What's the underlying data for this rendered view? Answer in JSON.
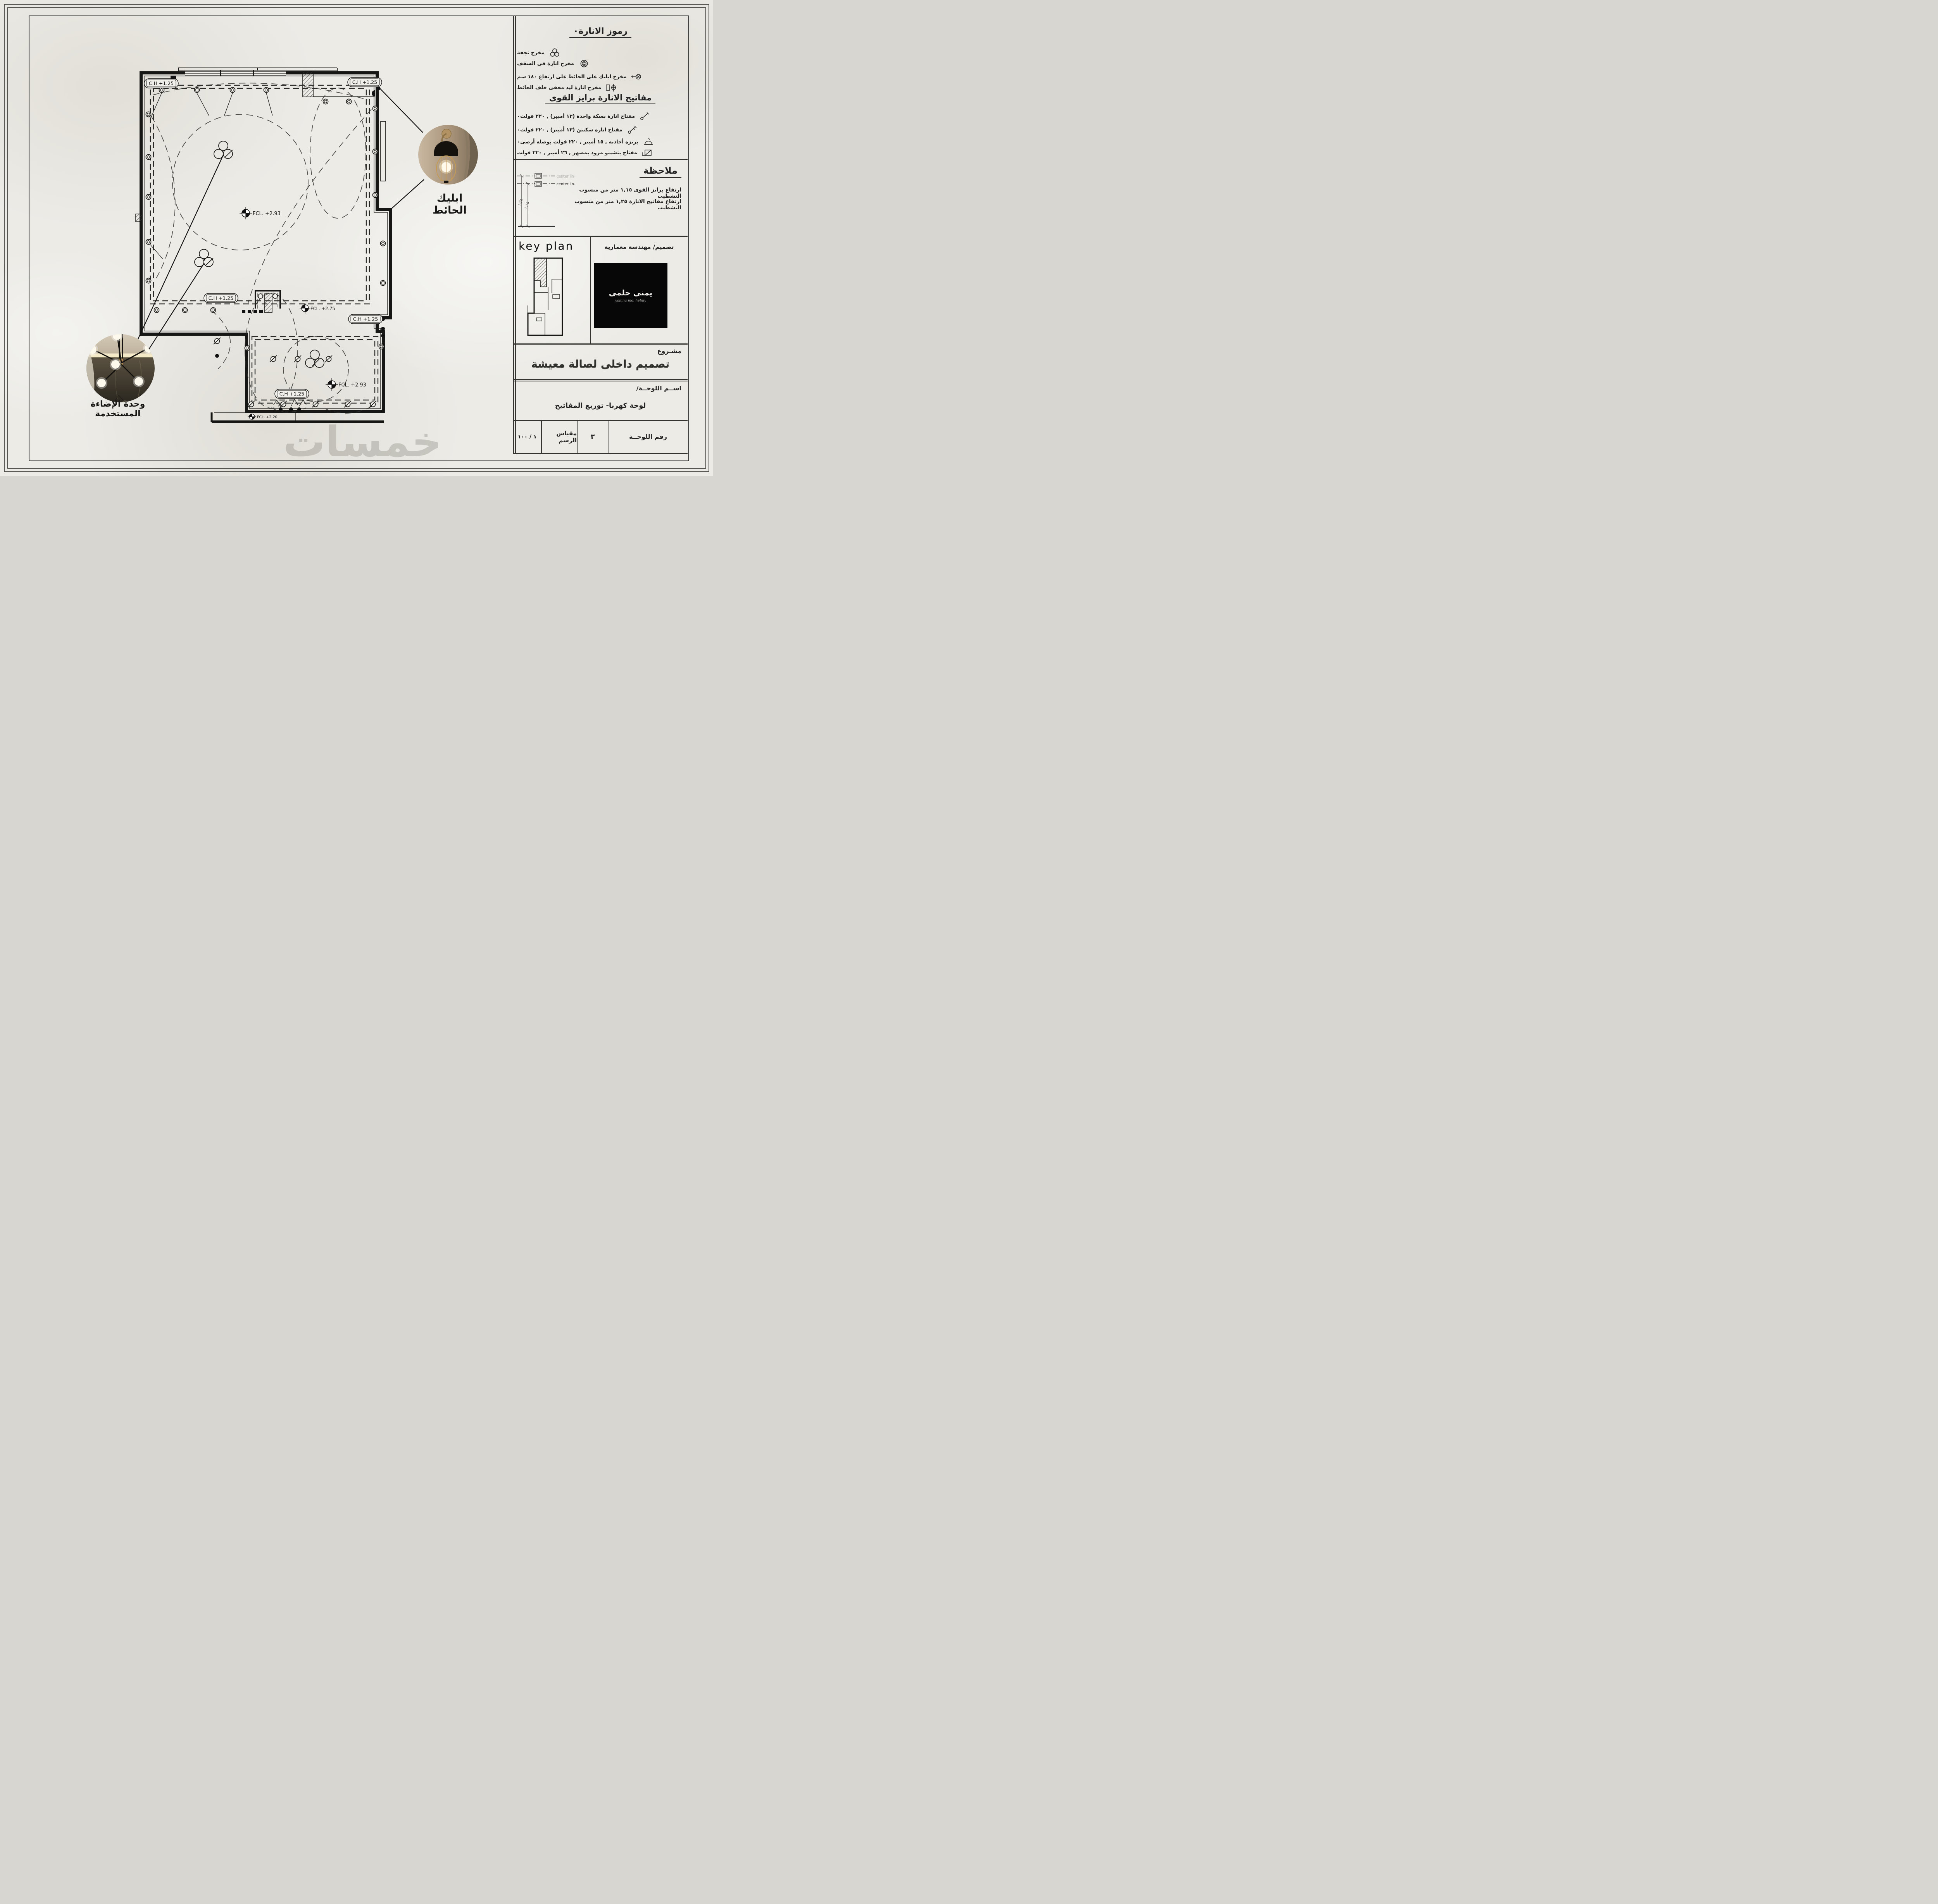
{
  "sheet": {
    "watermark": "خمسات"
  },
  "legend_lighting": {
    "title": "رموز الانارة٠",
    "items": [
      {
        "label": "مخرج نجفة",
        "icon": "chandelier-outlet-icon"
      },
      {
        "label": "مخرج انارة فى السقف",
        "icon": "ceiling-light-outlet-icon"
      },
      {
        "label": "مخرج ابليك على الحائط على ارتفاع ١٨٠ سم",
        "icon": "wall-sconce-outlet-icon"
      },
      {
        "label": "مخرج انارة ليد مخفى خلف الحائط",
        "icon": "hidden-led-outlet-icon"
      }
    ]
  },
  "legend_switches": {
    "title": "مفاتيح الانارة  برايز القوى",
    "items": [
      {
        "label": "مفتاح انارة بسكة واحدة (١٣ أمبير) , ٢٢٠ فولت٠",
        "icon": "one-way-switch-icon"
      },
      {
        "label": "مفتاح انارة سكتين (١٣ أمبير) , ٢٢٠ فولت٠",
        "icon": "two-way-switch-icon"
      },
      {
        "label": "بريزة أحادية , ١٥ أمبير , ٢٢٠ فولت بوصلة أرضى٠",
        "icon": "single-socket-icon"
      },
      {
        "label": "مفتاح بتشينو مزود بمصهر , ٢٦ أمبير , ٢٢٠ فولت",
        "icon": "fused-switch-icon"
      }
    ]
  },
  "note": {
    "title": "ملاحظة",
    "lines": [
      "ارتفاع برايز القوى ١,١٥ متر من منسوب التشطيب",
      "ارتفاع مفاتيح الانارة ١,٢٥ متر من منسوب التشطيب"
    ],
    "diagram": {
      "center_line_label": "center line",
      "dim_switch": "١,٢٥",
      "dim_socket": "١,١٥"
    }
  },
  "key_plan": {
    "title": "key  plan",
    "designer_label": "تصميم/ مهندسة معمارية",
    "logo_arabic": "يمنى حلمى",
    "logo_latin": "yomna mo. helmy"
  },
  "project": {
    "label": "مشـروع",
    "title": "تصميم داخلى لصالة معيشة"
  },
  "sheet_name": {
    "label": "اســم اللوحــة/",
    "value": "لوحة كهربا- توزيع المفاتيح"
  },
  "title_row": {
    "number_label": "رقم اللوحــة",
    "number_value": "٣",
    "scale_label": "مقياس الرسم",
    "scale_value": "١ / ١٠٠"
  },
  "plan": {
    "ch_label": "C.H +1.25",
    "fcl_293": "FCL. +2.93",
    "fcl_275": "FCL. +2.75",
    "fcl_220": "FCL. +2.20"
  },
  "callouts": {
    "sconce_label": "ابليك الحائط",
    "chandelier_label": "وحدة الإضاءة المستخدمة"
  }
}
